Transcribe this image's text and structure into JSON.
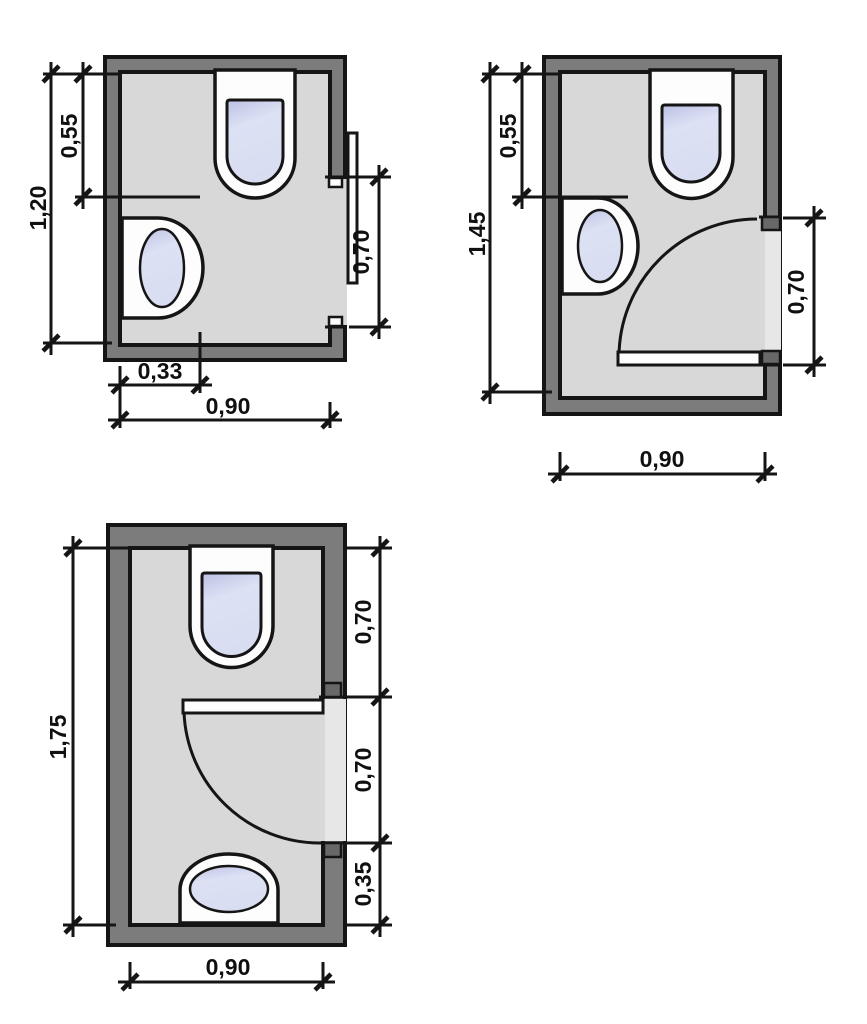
{
  "colors": {
    "wall": "#7c7c7c",
    "floor": "#d8d8d8",
    "threshold": "#e7e7e7",
    "line": "#151515",
    "fixture": "#fdfdfd",
    "basin_light": "#dde1f4",
    "basin_shade": "#bcc0e4",
    "jamb": "#686868"
  },
  "plans": [
    {
      "name": "wc-plan-sliding-door",
      "dims": {
        "upper_zone": "0,55",
        "total_height": "1,20",
        "fixture_offset": "0,33",
        "total_width": "0,90",
        "door_width": "0,70"
      }
    },
    {
      "name": "wc-plan-inswing-door",
      "dims": {
        "upper_zone": "0,55",
        "total_height": "1,45",
        "door_width": "0,70",
        "total_width": "0,90"
      }
    },
    {
      "name": "wc-plan-long-inswing-door",
      "dims": {
        "total_height": "1,75",
        "top_zone": "0,70",
        "door_width": "0,70",
        "bottom_zone": "0,35",
        "total_width": "0,90"
      }
    }
  ]
}
